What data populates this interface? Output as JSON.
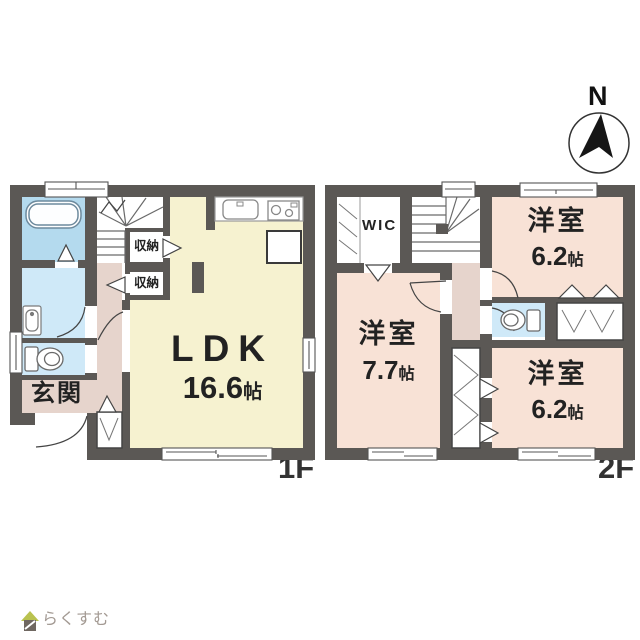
{
  "floor1": {
    "label": "1F",
    "ldk": {
      "label": "LDK",
      "size": "16.6",
      "unit": "帖"
    },
    "genkan": {
      "label": "玄関"
    },
    "storage1": {
      "label": "収納"
    },
    "storage2": {
      "label": "収納"
    },
    "underfloor": {
      "line1": "床下",
      "line2": "収納"
    }
  },
  "floor2": {
    "label": "2F",
    "wic": {
      "label": "WIC"
    },
    "room_ne": {
      "label": "洋室",
      "size": "6.2",
      "unit": "帖"
    },
    "room_sw": {
      "label": "洋室",
      "size": "7.7",
      "unit": "帖"
    },
    "room_se": {
      "label": "洋室",
      "size": "6.2",
      "unit": "帖"
    }
  },
  "compass": {
    "label": "N",
    "icon": "compass-north-icon"
  },
  "logo": {
    "text": "らくすむ",
    "icon": "house-icon"
  },
  "palette": {
    "wall": "#5b5855",
    "ldk_floor": "#f6f2d0",
    "western_room_floor": "#f8e2d6",
    "hallway_floor": "#e6d4cc",
    "bathroom_floor": "#b4daee",
    "sanitary_floor": "#cfe9f8",
    "line": "#4a4a4a"
  }
}
